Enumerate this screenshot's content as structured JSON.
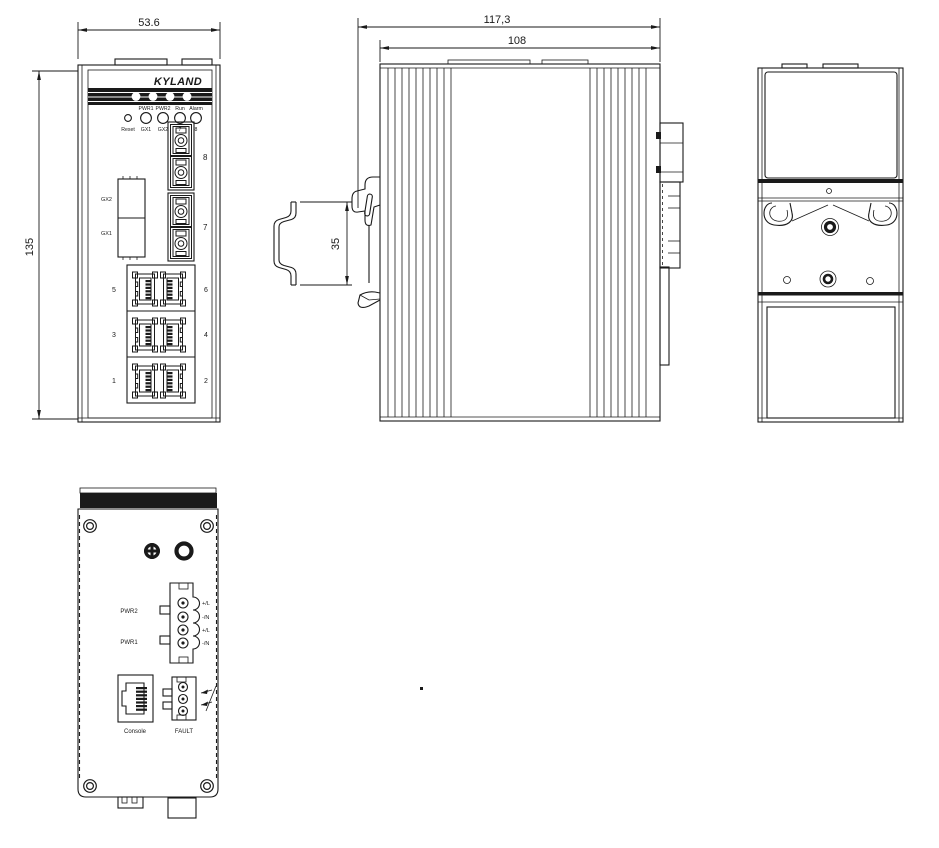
{
  "brand": "KYLAND",
  "dimensions": {
    "front_width": "53.6",
    "front_height": "135",
    "depth_total": "117,3",
    "depth_body": "108",
    "din_rail": "35"
  },
  "front": {
    "led_labels_top": [
      "PWR1",
      "PWR2",
      "Run",
      "Alarm"
    ],
    "reset_label": "Reset",
    "led_labels_bottom": [
      "GX1",
      "GX2",
      "7",
      "8"
    ],
    "slot_top": "GX2",
    "slot_bottom": "GX1",
    "fiber_top": "8",
    "fiber_bottom": "7",
    "rj45_left": [
      "5",
      "3",
      "1"
    ],
    "rj45_right": [
      "6",
      "4",
      "2"
    ]
  },
  "bottom": {
    "pwr2": "PWR2",
    "pwr1": "PWR1",
    "terminals": [
      "+/L",
      "-/N",
      "+/L",
      "-/N"
    ],
    "console": "Console",
    "fault": "FAULT"
  }
}
